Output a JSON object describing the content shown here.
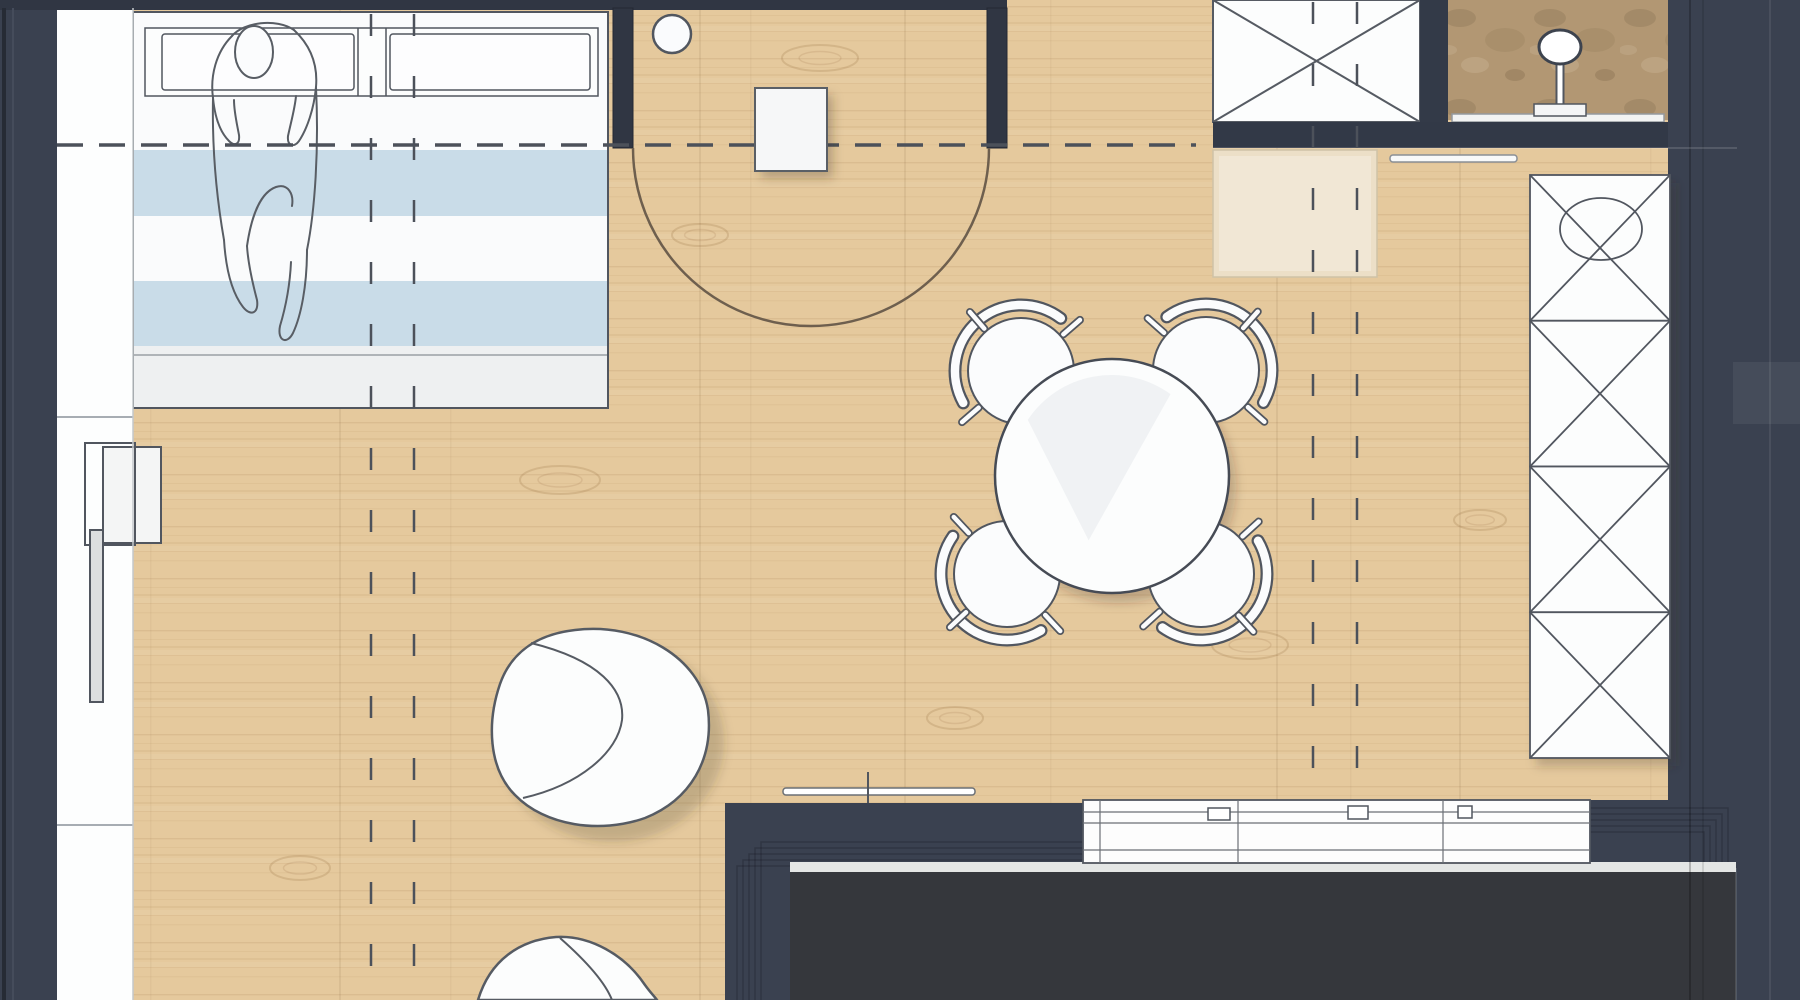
{
  "plan": {
    "name": "studio-apartment-floor-plan",
    "canvas": {
      "width": 1800,
      "height": 1000
    },
    "colors": {
      "floor": "#e5c99d",
      "wall": "#3a4150",
      "wall_dark": "#303643",
      "wall_edge": "#232833",
      "void": "#35373c",
      "white": "#fbfcfd",
      "outline": "#51565f",
      "stripe_blue": "#c9dce8",
      "stripe_white": "#fafbfc",
      "bed_foot": "#eef0f1",
      "rug": "#ecdfc7",
      "rug_line": "#cfc2a7",
      "gray_strip": "#e4e6e5",
      "arc": "#6e5f4e",
      "dash": "#4c515a",
      "fixture": "#f4f5f6"
    },
    "elements": [
      "bed-with-person",
      "left-closet",
      "radiator",
      "entry-stool",
      "entry-side-table",
      "door-swing",
      "shaft-x-box",
      "shower-niche",
      "towel-rail",
      "entry-rug",
      "tall-wardrobe",
      "dining-table",
      "dining-chairs",
      "armchair",
      "pouf",
      "kitchen-counter",
      "section-lines"
    ],
    "bed": {
      "x": 133,
      "y": 12,
      "w": 475,
      "h": 396,
      "pillow_band": {
        "x": 145,
        "y": 28,
        "w": 453,
        "h": 68,
        "dividers": [
          358,
          386
        ]
      },
      "pillows": [
        {
          "x": 162,
          "y": 34,
          "w": 192,
          "h": 56
        },
        {
          "x": 390,
          "y": 34,
          "w": 200,
          "h": 56
        }
      ],
      "stripes": [
        {
          "y": 96,
          "h": 54,
          "color": "stripe_white"
        },
        {
          "y": 150,
          "h": 66,
          "color": "stripe_blue"
        },
        {
          "y": 216,
          "h": 65,
          "color": "stripe_white"
        },
        {
          "y": 281,
          "h": 65,
          "color": "stripe_blue"
        }
      ],
      "foot": {
        "y": 346,
        "h": 62,
        "seam_y": 355
      }
    },
    "dining": {
      "table": {
        "cx": 1112,
        "cy": 476,
        "r": 117
      },
      "chair_r": 53,
      "back_r": 66,
      "chairs": [
        {
          "cx": 1021,
          "cy": 371
        },
        {
          "cx": 1206,
          "cy": 370
        },
        {
          "cx": 1007,
          "cy": 574
        },
        {
          "cx": 1201,
          "cy": 574
        }
      ]
    },
    "wardrobe": {
      "x": 1530,
      "y": 175,
      "w": 140,
      "h": 583,
      "panels": 4,
      "circle": {
        "cx": 1601,
        "cy": 229,
        "rx": 41,
        "ry": 31
      }
    },
    "shaft_box": {
      "x": 1213,
      "y": 0,
      "w": 207,
      "h": 122
    },
    "shower": {
      "x": 1448,
      "y": 0,
      "w": 220,
      "h": 120,
      "head": {
        "cx": 1560,
        "cy": 47,
        "rx": 21,
        "ry": 17
      },
      "sill": {
        "x": 1452,
        "y": 114,
        "w": 212,
        "h": 8
      }
    },
    "rug": {
      "x": 1213,
      "y": 150,
      "w": 164,
      "h": 127
    },
    "towel_rail": {
      "x": 1390,
      "y": 155,
      "w": 127,
      "h": 7
    },
    "threshold": {
      "x": 783,
      "y": 788,
      "w": 192,
      "h": 7,
      "tick_x": 868
    },
    "counter": {
      "x": 1083,
      "y": 800,
      "w": 507,
      "h": 63,
      "h_lines": [
        812,
        823,
        850
      ],
      "v_lines": [
        1100,
        1238,
        1443
      ],
      "handles": [
        {
          "x": 1208,
          "y": 808,
          "w": 22,
          "h": 12
        },
        {
          "x": 1348,
          "y": 806,
          "w": 20,
          "h": 13
        },
        {
          "x": 1458,
          "y": 806,
          "w": 14,
          "h": 12
        }
      ]
    },
    "entry": {
      "stool": {
        "cx": 672,
        "cy": 34,
        "r": 19
      },
      "table": {
        "x": 755,
        "y": 88,
        "w": 72,
        "h": 83
      },
      "arc": {
        "cx": 811,
        "cy": 148,
        "r": 178
      },
      "piers": [
        {
          "x": 613,
          "y": 8,
          "w": 20,
          "h": 140
        },
        {
          "x": 987,
          "y": 8,
          "w": 20,
          "h": 140
        }
      ]
    },
    "left_side": {
      "wall": {
        "x": 0,
        "y": 8,
        "w": 57,
        "h": 992
      },
      "closet": {
        "x": 57,
        "y": 8,
        "w": 76,
        "h": 992,
        "seams": [
          417,
          825
        ]
      },
      "box_a": {
        "x": 103,
        "y": 447,
        "w": 58,
        "h": 96
      },
      "box_b": {
        "x": 85,
        "y": 443,
        "w": 50,
        "h": 102
      },
      "radiator": {
        "x": 90,
        "y": 530,
        "w": 13,
        "h": 172
      }
    },
    "section_lines": {
      "horizontal": {
        "y": 145,
        "x1": 57,
        "x2": 1196,
        "dasharray": "26 16",
        "width": 3.5
      },
      "vertical_dasharray": "22 40",
      "vertical_width": 2.5,
      "vertical": [
        {
          "x": 371,
          "y1": 14,
          "y2": 1000
        },
        {
          "x": 414,
          "y1": 14,
          "y2": 1000
        },
        {
          "x": 1313,
          "y1": 2,
          "y2": 798
        },
        {
          "x": 1357,
          "y1": 2,
          "y2": 798
        }
      ]
    },
    "walls": {
      "top_band": {
        "x": 0,
        "y": 0,
        "w": 1007,
        "h": 10
      },
      "under_box_band": {
        "x": 1213,
        "y": 122,
        "w": 524,
        "h": 26
      },
      "box_divider": {
        "x": 1420,
        "y": 0,
        "w": 28,
        "h": 122
      },
      "right_region": {
        "x": 1668,
        "y": 0,
        "w": 132,
        "h": 1000
      },
      "kitchen_block": {
        "x": 725,
        "y": 803,
        "w": 358,
        "h": 69
      },
      "kitchen_leg": {
        "x": 725,
        "y": 803,
        "w": 65,
        "h": 197
      },
      "kitchen_right_block": {
        "x": 1590,
        "y": 800,
        "w": 146,
        "h": 72
      },
      "void": {
        "x": 790,
        "y": 872,
        "w": 946,
        "h": 128
      },
      "gray_strip": {
        "x": 790,
        "y": 862,
        "w": 946,
        "h": 10
      },
      "corner_steps": 5
    },
    "floor_seams": [
      340,
      700,
      905,
      1277,
      1460
    ],
    "wood_knots": [
      {
        "cx": 820,
        "cy": 58,
        "rx": 38,
        "ry": 13
      },
      {
        "cx": 700,
        "cy": 235,
        "rx": 28,
        "ry": 11
      },
      {
        "cx": 560,
        "cy": 480,
        "rx": 40,
        "ry": 14
      },
      {
        "cx": 300,
        "cy": 868,
        "rx": 30,
        "ry": 12
      },
      {
        "cx": 1250,
        "cy": 645,
        "rx": 38,
        "ry": 14
      },
      {
        "cx": 955,
        "cy": 718,
        "rx": 28,
        "ry": 11
      },
      {
        "cx": 1480,
        "cy": 520,
        "rx": 26,
        "ry": 10
      }
    ],
    "seam_lines": [
      {
        "x1": 4,
        "y1": 8,
        "x2": 4,
        "y2": 1000,
        "c": "#262b35",
        "w": 4
      },
      {
        "x1": 13,
        "y1": 8,
        "x2": 13,
        "y2": 1000,
        "c": "#454c5b",
        "w": 2
      },
      {
        "x1": 1690,
        "y1": 0,
        "x2": 1690,
        "y2": 1000,
        "c": "rgba(0,0,0,0.22)",
        "w": 2
      },
      {
        "x1": 1703,
        "y1": 0,
        "x2": 1703,
        "y2": 1000,
        "c": "rgba(0,0,0,0.14)",
        "w": 1.5
      },
      {
        "x1": 1736,
        "y1": 868,
        "x2": 1736,
        "y2": 1000,
        "c": "rgba(255,255,255,0.12)",
        "w": 2
      },
      {
        "x1": 1770,
        "y1": 0,
        "x2": 1770,
        "y2": 1000,
        "c": "rgba(255,255,255,0.08)",
        "w": 2
      },
      {
        "x1": 57,
        "y1": 417,
        "x2": 133,
        "y2": 417,
        "c": "#a7adb3",
        "w": 2
      },
      {
        "x1": 57,
        "y1": 825,
        "x2": 133,
        "y2": 825,
        "c": "#a7adb3",
        "w": 2
      },
      {
        "x1": 133,
        "y1": 8,
        "x2": 133,
        "y2": 1000,
        "c": "#c4c8cc",
        "w": 1.5
      },
      {
        "x1": 1213,
        "y1": 148,
        "x2": 1737,
        "y2": 148,
        "c": "rgba(255,255,255,0.18)",
        "w": 1.5
      }
    ]
  }
}
